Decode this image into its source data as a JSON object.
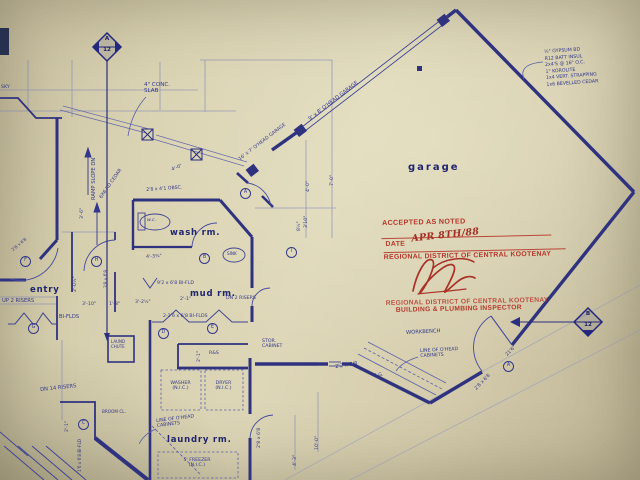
{
  "rooms": {
    "garage": "garage",
    "entry": "entry",
    "wash": "wash rm.",
    "mud": "mud rm.",
    "laundry": "laundry rm."
  },
  "markers": {
    "a_letter": "A",
    "a_number": "12",
    "b_letter": "B",
    "b_number": "12"
  },
  "stamp": {
    "accepted": "ACCEPTED AS NOTED",
    "date_label": "DATE",
    "date_value": "APR 8TH/88",
    "district_line1": "REGIONAL DISTRICT OF CENTRAL KOOTENAY",
    "district_line2": "REGIONAL DISTRICT OF CENTRAL KOOTENAY",
    "inspector": "BUILDING & PLUMBING INSPECTOR"
  },
  "wall_note": "½\" GYPSUM BD\nR12 BATT INSUL\n2x4'S @ 16\" O.C.\n1\" KOROLITE\n1x4 VERT. STRAPPING\n1x6 BEVELLED CEDAR",
  "notes": {
    "conc_slab": "4\" CONC.\nSLAB",
    "ramp": "RAMP SLOPE DN",
    "cedar_post": "6X6 RD CEDAR",
    "ohead_door_1": "9' x 8' O'HEAD GARAGE",
    "ohead_door_2": "16' x 7' O'HEAD GARAGE",
    "workbench": "WORKBENCH",
    "cabinets_garage": "LINE OF O'HEAD\nCABINETS",
    "cabinets_laundry": "LINE OF O'HEAD\nCABINETS",
    "washer": "WASHER\n(N.I.C.)",
    "dryer": "DRYER\n(N.I.C.)",
    "freezer": "5' FREEZER\n(N.I.C.)",
    "stor_cabinet": "STOR.\nCABINET",
    "laundry_chute": "LAUND\nCHUTE",
    "broom": "BROOM CL.",
    "wc": "w.c.",
    "sink": "SINK",
    "rod_shelf": "R&S",
    "sky": "SKY",
    "up2": "UP 2 RISERS",
    "dn2": "DN 2 RISERS",
    "dn14": "DN 14 RISERS",
    "biflds": "BI-FLDS",
    "bifld_mud": "2-2'6 x 6'8 BI-FLDS",
    "bifld_wash": "9'2 x 6'8 BI-FLD",
    "bifld_stair": "1'6 x 6'8 BI-FLD"
  },
  "dims": {
    "d7_0": "7'-0\"",
    "d4_0a": "4'-0\"",
    "d4_0b": "4'-0\"",
    "d3_10a": "3'10\"",
    "d8_5": "8½\"",
    "obsc": "2'8 x 4'1 OBSC.",
    "d3_6": "3'-6\"",
    "d2_0h": "2'-0½\"",
    "d3_10b": "3'-10\"",
    "d1_8": "1'-8\"",
    "d3_2h": "3'-2½\"",
    "d2_1a": "2'-1\"",
    "d2_1b": "2'-1\"",
    "d2_1c": "2'-1\"",
    "door_f": "2'8 x 6'8",
    "door_h": "3'8 x 6'8",
    "door_a": "2'8 x 6'8",
    "door_l": "2'8 x 6'8",
    "win_gg": "2'2 x 3'8",
    "gg": "G.G.",
    "d21_6": "21'6\"",
    "d4_3": "4'-3\"",
    "d10_0": "10'-0\"",
    "d4_3q": "4'-3¾\""
  },
  "door_tags": {
    "a1": "A",
    "a2": "A",
    "b": "B",
    "c": "C",
    "d": "D",
    "e": "E",
    "f": "F",
    "g": "G",
    "h": "H",
    "i": "I"
  }
}
